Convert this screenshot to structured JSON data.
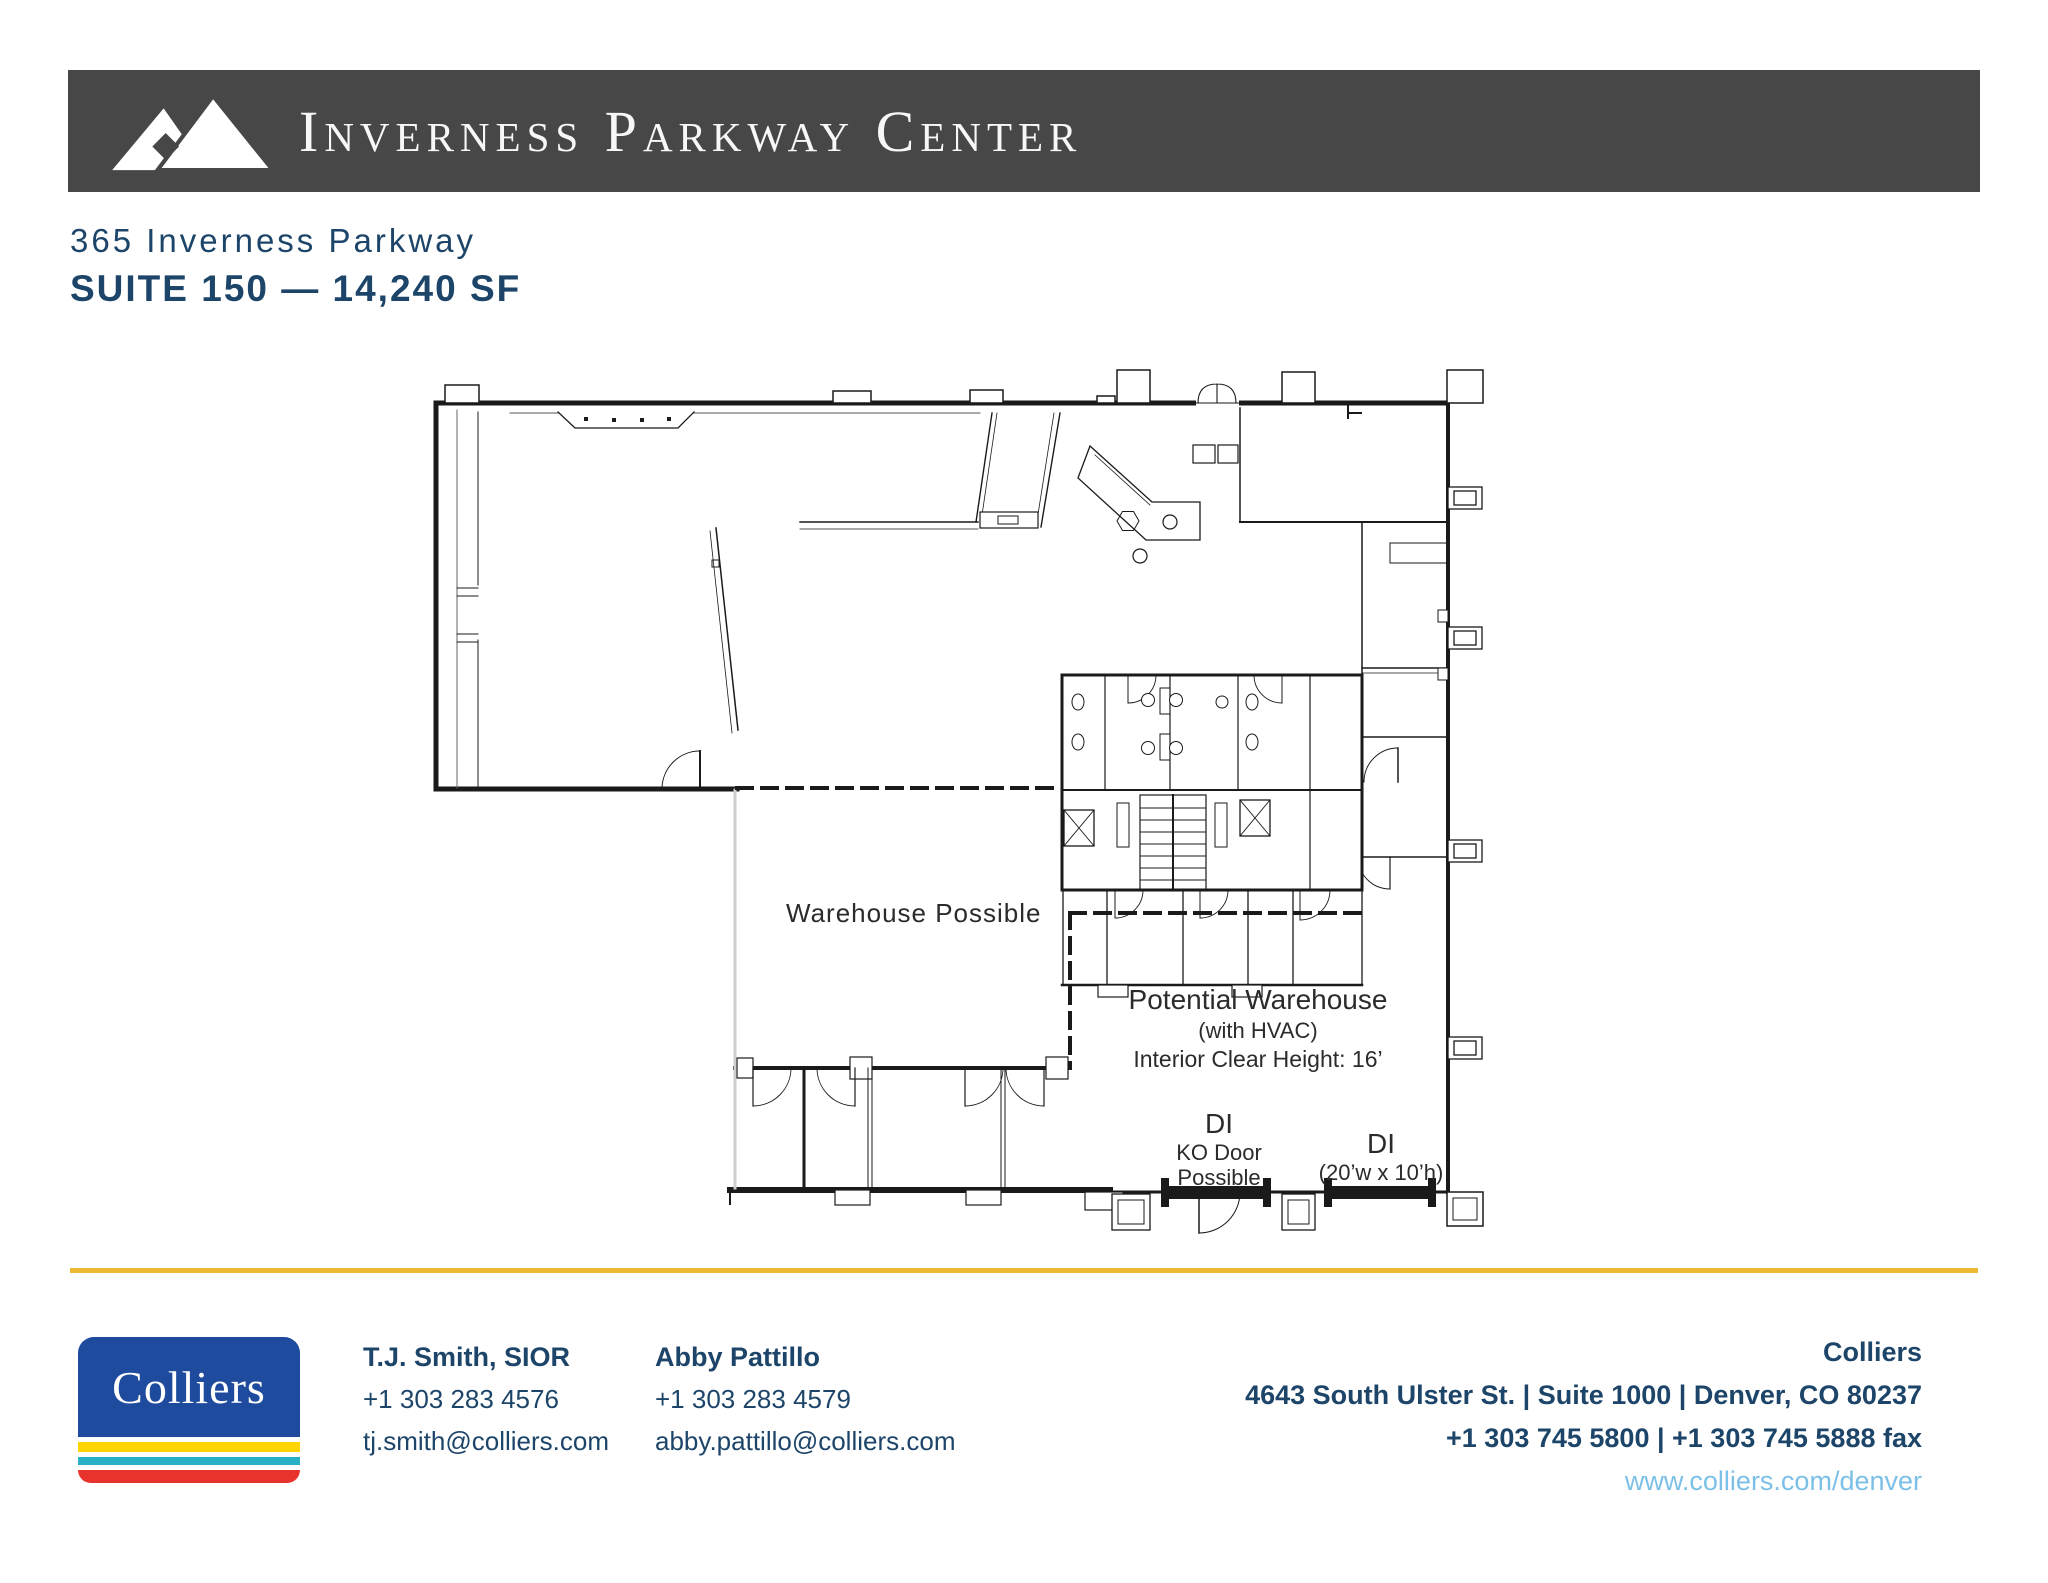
{
  "header": {
    "title": "Inverness Parkway Center"
  },
  "property": {
    "address": "365 Inverness Parkway",
    "suite": "SUITE 150 — 14,240 SF"
  },
  "plan": {
    "warehouse_label": "Warehouse Possible",
    "potential_warehouse": "Potential Warehouse",
    "hvac_note": "(with HVAC)",
    "clear_height": "Interior Clear Height: 16’",
    "di1": {
      "label": "DI",
      "line1": "KO Door",
      "line2": "Possible"
    },
    "di2": {
      "label": "DI",
      "size": "(20’w x 10’h)"
    }
  },
  "footer": {
    "logo_text": "Colliers",
    "contacts": [
      {
        "name": "T.J. Smith, SIOR",
        "phone": "+1 303 283 4576",
        "email": "tj.smith@colliers.com"
      },
      {
        "name": "Abby Pattillo",
        "phone": "+1 303 283 4579",
        "email": "abby.pattillo@colliers.com"
      }
    ],
    "office": {
      "name": "Colliers",
      "address": "4643 South Ulster St. | Suite 1000 | Denver, CO 80237",
      "phones": "+1 303 745 5800 | +1 303 745 5888 fax",
      "website": "www.colliers.com/denver"
    }
  },
  "colors": {
    "banner_gray": "#474747",
    "navy": "#1d4569",
    "gold": "#edb833",
    "colliers_blue": "#1e4b9e",
    "stripe_yellow": "#ffd400",
    "stripe_teal": "#2ab0c5",
    "stripe_red": "#e8332c",
    "link_blue": "#7cc0e8"
  }
}
